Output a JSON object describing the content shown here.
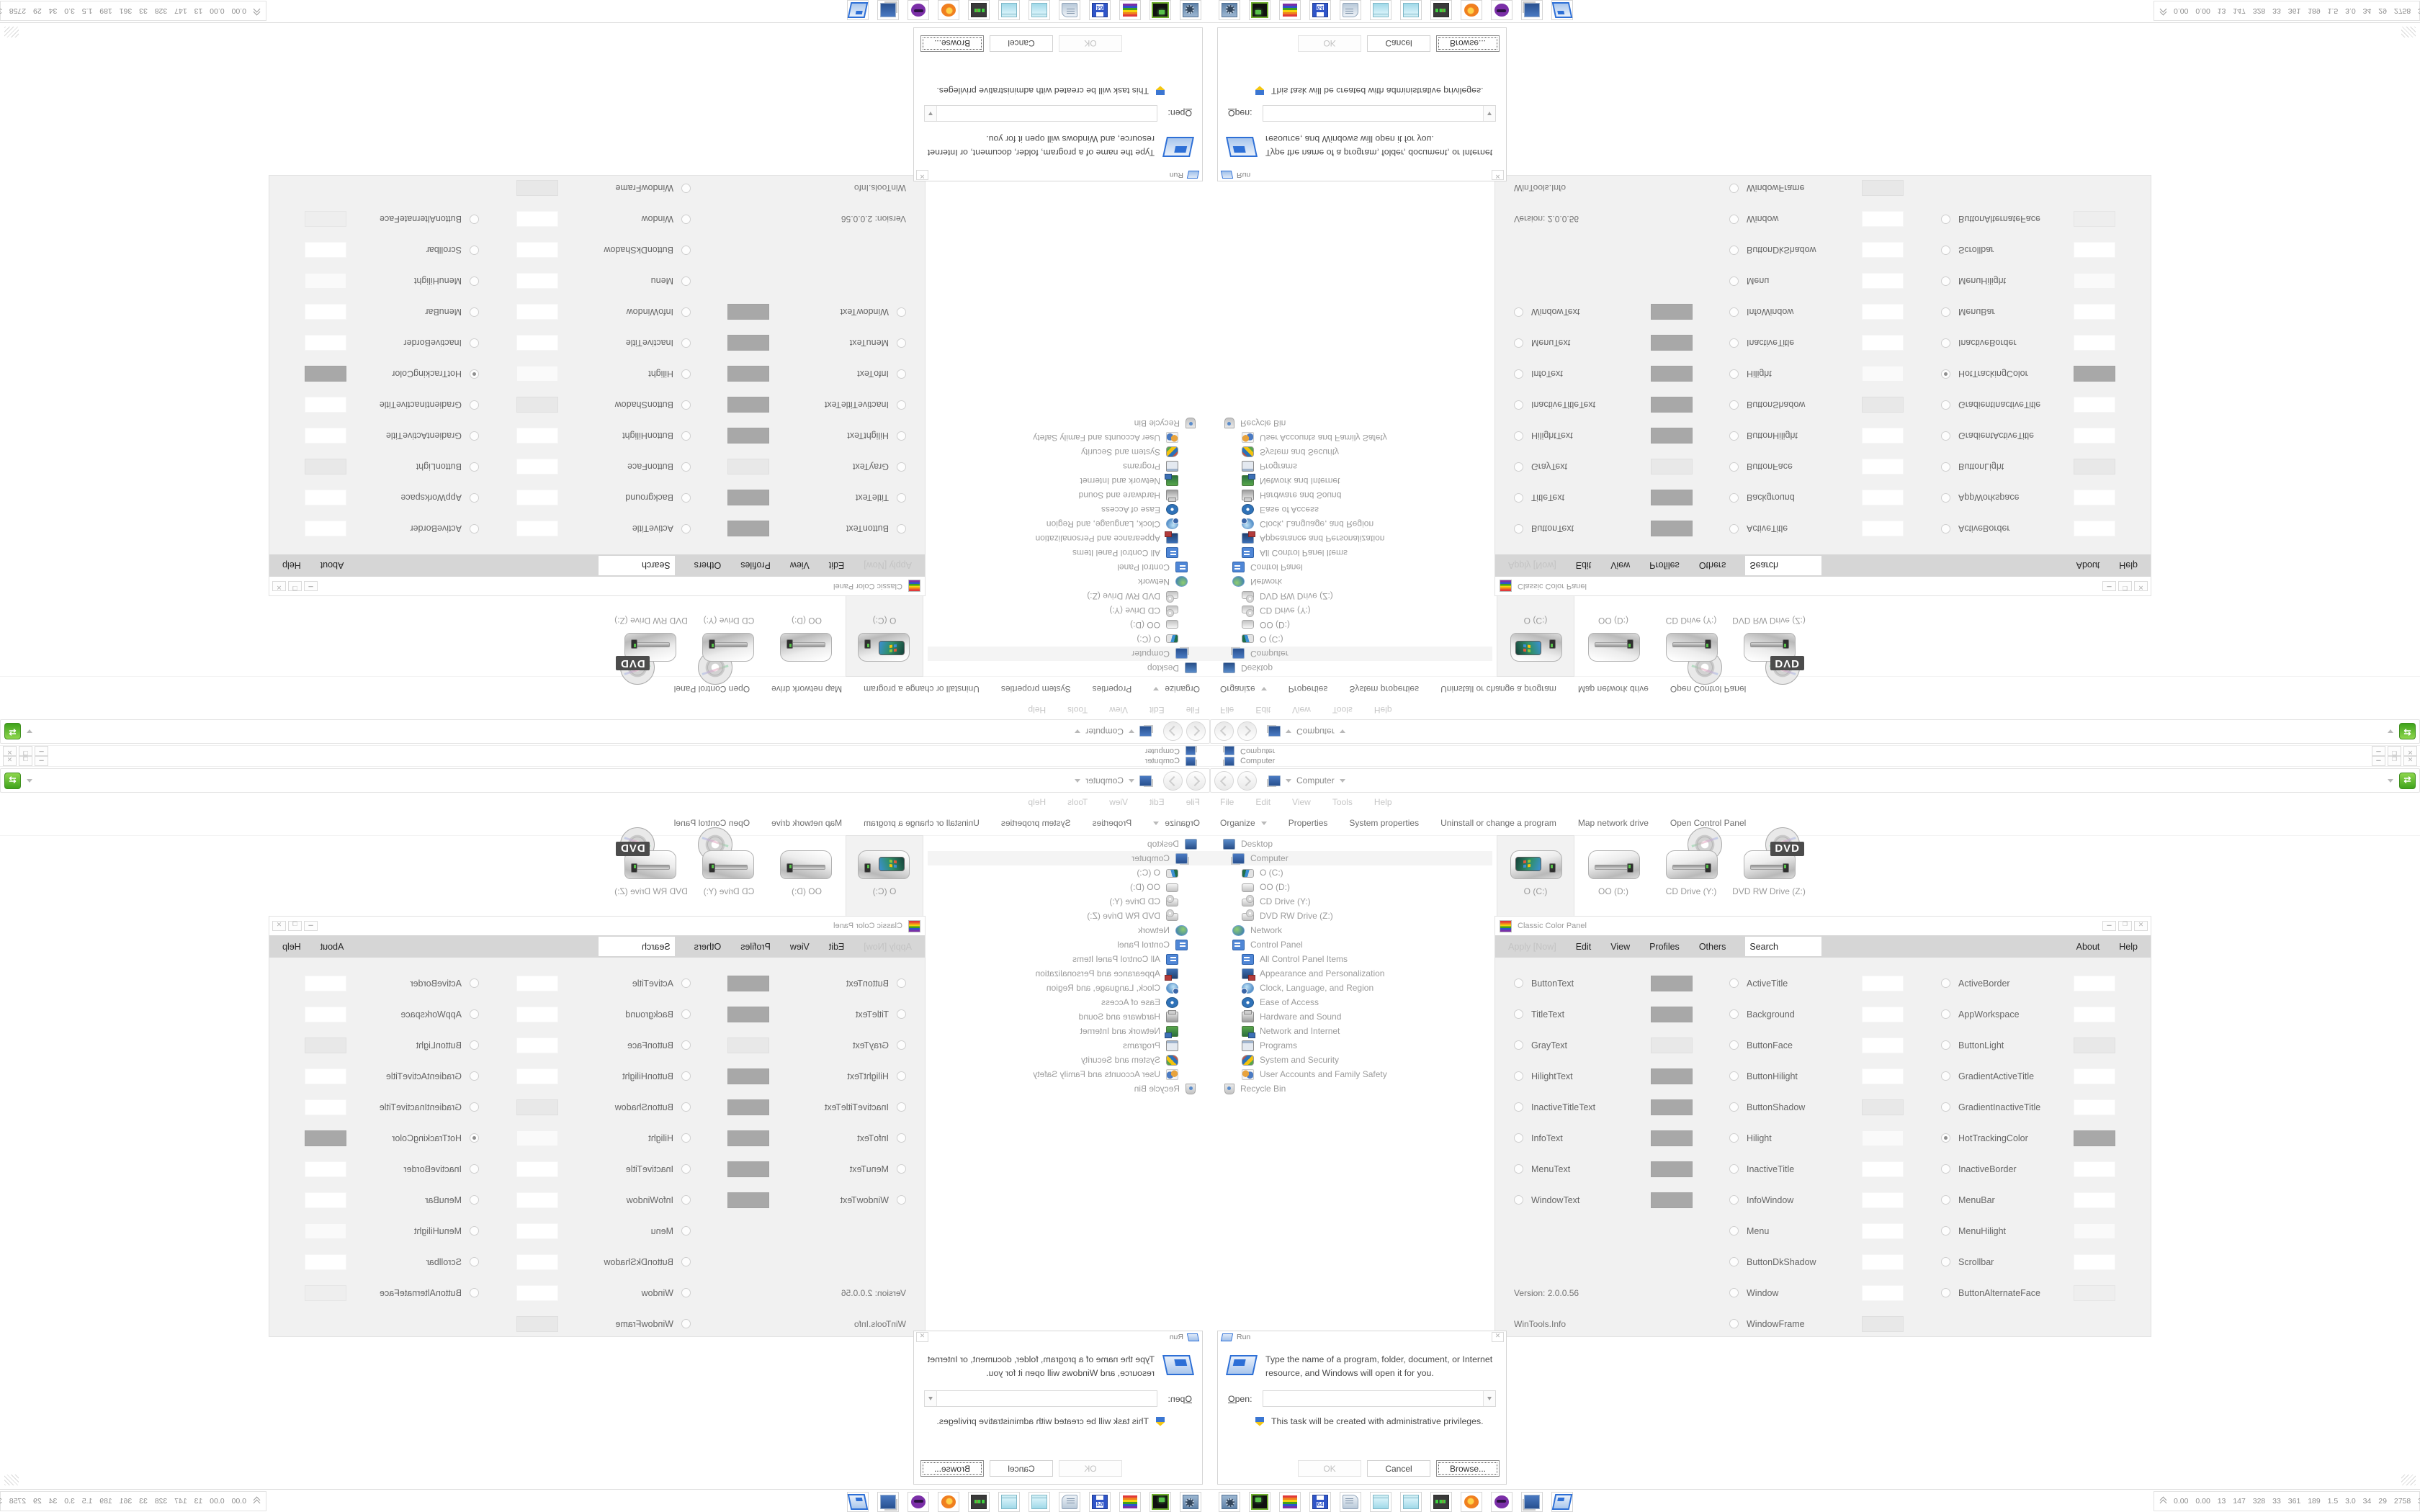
{
  "explorer": {
    "window_title": "Computer",
    "address_location": "Computer",
    "menu_items": [
      "File",
      "Edit",
      "View",
      "Tools",
      "Help"
    ],
    "command_bar": [
      "Organize",
      "Properties",
      "System properties",
      "Uninstall or change a program",
      "Map network drive",
      "Open Control Panel"
    ],
    "tree": [
      {
        "label": "Desktop",
        "icon": "desktop",
        "indent": 0
      },
      {
        "label": "Computer",
        "icon": "computer",
        "indent": 1,
        "selected": true
      },
      {
        "label": "O (C:)",
        "icon": "os-drive",
        "indent": 2
      },
      {
        "label": "OO (D:)",
        "icon": "drive",
        "indent": 2
      },
      {
        "label": "CD Drive (Y:)",
        "icon": "cd",
        "indent": 2
      },
      {
        "label": "DVD RW Drive (Z:)",
        "icon": "cd",
        "indent": 2
      },
      {
        "label": "Network",
        "icon": "network",
        "indent": 1
      },
      {
        "label": "Control Panel",
        "icon": "cpanel",
        "indent": 1
      },
      {
        "label": "All Control Panel Items",
        "icon": "cpanel",
        "indent": 2
      },
      {
        "label": "Appearance and Personalization",
        "icon": "appearance",
        "indent": 2
      },
      {
        "label": "Clock, Language, and Region",
        "icon": "clock",
        "indent": 2
      },
      {
        "label": "Ease of Access",
        "icon": "ease",
        "indent": 2
      },
      {
        "label": "Hardware and Sound",
        "icon": "hardware",
        "indent": 2
      },
      {
        "label": "Network and Internet",
        "icon": "netinet",
        "indent": 2
      },
      {
        "label": "Programs",
        "icon": "programs",
        "indent": 2
      },
      {
        "label": "System and Security",
        "icon": "syssec",
        "indent": 2
      },
      {
        "label": "User Accounts and Family Safety",
        "icon": "users",
        "indent": 2
      },
      {
        "label": "Recycle Bin",
        "icon": "recycle",
        "indent": 0
      }
    ],
    "items": [
      {
        "label": "O (C:)",
        "kind": "os-drive",
        "selected": true
      },
      {
        "label": "OO (D:)",
        "kind": "drive",
        "selected": false
      },
      {
        "label": "CD Drive (Y:)",
        "kind": "cd-drive",
        "selected": false
      },
      {
        "label": "DVD RW Drive (Z:)",
        "kind": "dvd-drive",
        "selected": false
      }
    ],
    "dvd_badge": "DVD"
  },
  "ccp": {
    "title": "Classic Color Panel",
    "menu": {
      "apply_label": "Apply [Now]",
      "items": [
        "Edit",
        "View",
        "Profiles",
        "Others"
      ],
      "search_label": "Search",
      "right_items": [
        "About",
        "Help"
      ]
    },
    "columns": [
      {
        "rows": [
          {
            "label": "ButtonText",
            "swatch": "#a8a8a8"
          },
          {
            "label": "TitleText",
            "swatch": "#a8a8a8"
          },
          {
            "label": "GrayText",
            "swatch": "#e8e8e8"
          },
          {
            "label": "HilightText",
            "swatch": "#a8a8a8"
          },
          {
            "label": "InactiveTitleText",
            "swatch": "#a8a8a8"
          },
          {
            "label": "InfoText",
            "swatch": "#a8a8a8"
          },
          {
            "label": "MenuText",
            "swatch": "#a8a8a8"
          },
          {
            "label": "WindowText",
            "swatch": "#a8a8a8"
          },
          {
            "blank": true
          },
          {
            "blank": true
          },
          {
            "note": "Version: 2.0.0.56"
          },
          {
            "note": "WinTools.Info"
          }
        ]
      },
      {
        "rows": [
          {
            "label": "ActiveTitle",
            "swatch": "#ffffff"
          },
          {
            "label": "Background",
            "swatch": "#ffffff"
          },
          {
            "label": "ButtonFace",
            "swatch": "#ffffff"
          },
          {
            "label": "ButtonHilight",
            "swatch": "#ffffff"
          },
          {
            "label": "ButtonShadow",
            "swatch": "#e8e8e8"
          },
          {
            "label": "Hilight",
            "swatch": "#fafafa"
          },
          {
            "label": "InactiveTitle",
            "swatch": "#ffffff"
          },
          {
            "label": "InfoWindow",
            "swatch": "#ffffff"
          },
          {
            "label": "Menu",
            "swatch": "#ffffff"
          },
          {
            "label": "ButtonDkShadow",
            "swatch": "#ffffff"
          },
          {
            "label": "Window",
            "swatch": "#ffffff"
          },
          {
            "label": "WindowFrame",
            "swatch": "#e8e8e8"
          }
        ]
      },
      {
        "rows": [
          {
            "label": "ActiveBorder",
            "swatch": "#ffffff"
          },
          {
            "label": "AppWorkspace",
            "swatch": "#ffffff"
          },
          {
            "label": "ButtonLight",
            "swatch": "#e8e8e8"
          },
          {
            "label": "GradientActiveTitle",
            "swatch": "#ffffff"
          },
          {
            "label": "GradientInactiveTitle",
            "swatch": "#ffffff"
          },
          {
            "label": "HotTrackingColor",
            "swatch": "#a8a8a8",
            "selected": true
          },
          {
            "label": "InactiveBorder",
            "swatch": "#ffffff"
          },
          {
            "label": "MenuBar",
            "swatch": "#ffffff"
          },
          {
            "label": "MenuHilight",
            "swatch": "#fafafa"
          },
          {
            "label": "Scrollbar",
            "swatch": "#ffffff"
          },
          {
            "label": "ButtonAlternateFace",
            "swatch": "#eeeeee"
          }
        ]
      }
    ]
  },
  "run": {
    "title": "Run",
    "message": "Type the name of a program, folder, document, or Internet resource, and Windows will open it for you.",
    "open_label_accel": "O",
    "open_label_rest": "pen:",
    "open_value": "",
    "admin_note": "This task will be created with administrative privileges.",
    "buttons": [
      {
        "label": "OK",
        "state": "disabled"
      },
      {
        "label": "Cancel",
        "state": "normal"
      },
      {
        "label": "Browse...",
        "state": "focused"
      }
    ]
  },
  "taskbar": {
    "buttons": [
      "system-settings",
      "hardware-monitor",
      "classic-color-panel",
      "floppy-64",
      "scroll-viewer",
      "notepad",
      "notepad",
      "resource-monitor",
      "firefox",
      "purple-avatar-app",
      "computer",
      "run"
    ],
    "floppy_label": "64",
    "monitor_values": "0.00 0.00 13 147 328 33 361 189 1.5 3.0 34 29 2758 3839"
  },
  "colors": {
    "accent_green": "#3fa31c",
    "window_bg": "#ffffff",
    "panel_bg": "#f1f1f1",
    "menu_strip": "#d6d6d6",
    "border": "#e3e3e3",
    "text_muted": "#9b9b9b"
  }
}
